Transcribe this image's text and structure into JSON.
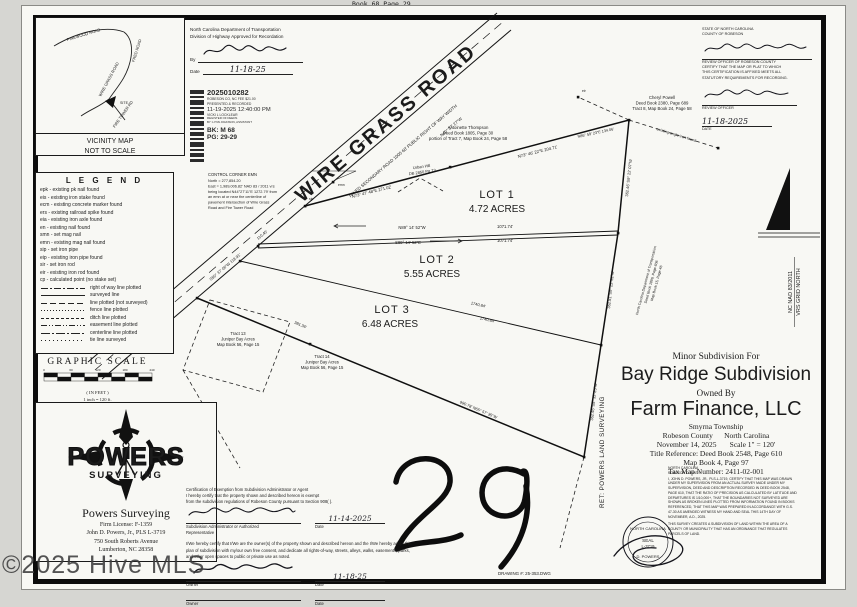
{
  "page": {
    "book_header": "Book 68 Page 29",
    "page_number": "29",
    "drawing_number": "DRAWING #: 25-353.DWG",
    "watermark": "©2025 Hive MLS",
    "ret_label": "RET: POWERS LAND SURVEYING"
  },
  "vicinity": {
    "roads": [
      "PINEWOOD ROAD",
      "FRED ROAD",
      "WIRE GRASS ROAD",
      "FIRE TOWER RD"
    ],
    "site_label": "SITE",
    "caption1": "VICINITY MAP",
    "caption2": "NOT TO SCALE"
  },
  "ncdot": {
    "line1": "North Carolina Department of Transportation",
    "line2": "Division of Highway Approved for Recordation",
    "by_label": "By",
    "date_label": "Date",
    "date_value": "11-18-25"
  },
  "stamp": {
    "number": "2025010282",
    "line1": "ROBESON CO, NC FEE $21.00",
    "line2": "PRESENTED & RECORDED",
    "datetime": "11-19-2025 12:40:00 PM",
    "registrar": "VICKI L LOCKLEAR",
    "registrar_title": "REGISTER OF DEEDS",
    "deputy": "BY: LYNN JOHNSON, ASSISTANT",
    "book": "BK: M 68",
    "page": "PG: 29-29"
  },
  "legend": {
    "title": "L E G E N D",
    "abbrevs": [
      "epk - existing pk nail found",
      "eis - existing iron stake found",
      "ecm - existing concrete marker found",
      "ers - existing railroad spike found",
      "eia - existing iron axle found",
      "en - existing nail found",
      "smn - set mag nail",
      "emn - existing mag nail found",
      "sip - set iron pipe",
      "eip - existing iron pipe found",
      "sir - set iron rod",
      "eir - existing iron rod found",
      "cp - calculated point (no stake set)"
    ],
    "lines": [
      {
        "label": "right of way line plotted",
        "dash": "7 2 2 2"
      },
      {
        "label": "surveyed line",
        "dash": ""
      },
      {
        "label": "line plotted (not surveyed)",
        "dash": "6 3"
      },
      {
        "label": "fence line plotted",
        "dash": "1 2"
      },
      {
        "label": "ditch line plotted",
        "dash": "3 2"
      },
      {
        "label": "easement line plotted",
        "dash": "6 2 1 2 1 2"
      },
      {
        "label": "centerline line plotted",
        "dash": "9 2 2 2"
      },
      {
        "label": "tie line surveyed",
        "dash": "1 3"
      }
    ]
  },
  "scale_bar": {
    "title": "GRAPHIC SCALE",
    "ticks": [
      "0",
      "60",
      "120",
      "180",
      "240"
    ],
    "units": "( IN FEET )",
    "note": "1 inch = 120 ft."
  },
  "powers": {
    "brand_top": "POWERS",
    "brand_bottom": "SURVEYING",
    "firm": "Powers Surveying",
    "license": "Firm License:  F-1359",
    "surveyor": "John D. Powers, Jr., PLS L-3719",
    "address1": "750 South Roberts Avenue",
    "address2": "Lumberton, NC 28358"
  },
  "review": {
    "state": "STATE OF NORTH CAROLINA",
    "county": "COUNTY OF ROBESON",
    "body1": "REVIEW OFFICER OF ROBESON COUNTY",
    "body2": "CERTIFY THAT THE MAP OR PLAT TO WHICH",
    "body3": "THIS CERTIFICATION IS AFFIXED MEETS ALL",
    "body4": "STATUTORY REQUIREMENTS FOR RECORDING.",
    "officer_label": "REVIEW OFFICER",
    "date_value": "11-18-2025",
    "date_label": "DATE"
  },
  "title_block": {
    "sub": "Minor Subdivision For",
    "name": "Bay Ridge Subdivision",
    "owned": "Owned By",
    "owner": "Farm Finance, LLC",
    "township": "Smyrna Township",
    "county": "Robeson County      North Carolina",
    "date_scale": "November 14, 2025       Scale 1\" = 120'",
    "ref1": "Title Reference:  Deed Book 2548, Page 610",
    "ref2": "Map Book 4, Page 97",
    "ref3": "Tax Map Number: 2411-02-001"
  },
  "surveyor_cert": {
    "state": "NORTH CAROLINA",
    "county": "ROBESON COUNTY",
    "body": "I, JOHN D. POWERS, JR., PLS-L-3719, CERTIFY THAT THIS MAP WAS DRAWN UNDER MY SUPERVISION FROM AN ACTUAL SURVEY MADE UNDER MY SUPERVISION, DEED AND DESCRIPTION RECORDED IN DEED BOOK 2548, PAGE 610, THAT THE RATIO OF PRECISION AS CALCULATED BY LATITUDE AND DEPARTURES IS 1/10,000+, THAT THE BOUNDARIES NOT SURVEYED ARE SHOWN AS BROKEN LINES PLOTTED FROM INFORMATION FOUND IN BOOKS REFERENCED, THAT THIS MAP WAS PREPARED IN ACCORDANCE WITH G.S. 47-30 AS AMENDED WITNESS MY HAND AND SEAL THIS 14TH DAY OF NOVEMBER, A.D., 2025.",
    "body2": "THIS SURVEY CREATES A SUBDIVISION OF LAND WITHIN THE AREA OF A COUNTY OR MUNICIPALITY THAT HAS AN ORDINANCE THAT REGULATES PARCELS OF LAND."
  },
  "seal": {
    "top": "NORTH CAROLINA",
    "mid1": "SEAL",
    "mid2": "L-3719",
    "bottom": "D. POWERS"
  },
  "exemption": {
    "title": "Certification of Exemption from Subdivision Administrator or Agent",
    "p1a": "I hereby certify that the property shown and described hereon is exempt",
    "p1b": "from the subdivision regulations of Robeson County pursuant to Section 908( ).",
    "admin_label1": "Subdivision Administrator or Authorized",
    "admin_label2": "Representative",
    "admin_date": "11-14-2025",
    "date_label": "Date",
    "p2": "I/We hereby certify that I/We are the owner(s) of the property shown and described hereon and the I/We hereby adopt this plan of subdivision with my/our own free consent, and dedicate all rights-of-way, streets, alleys, walks, easements, parks, and other open spaces to public or private use as noted.",
    "owner_label": "Owner",
    "owner_date": "11-18-25"
  },
  "north": {
    "line1": "NC NAD 83/2011",
    "line2": "VRS GRID NORTH"
  },
  "map": {
    "road_name": "WIRE GRASS ROAD",
    "road_sub": "PAVED SECONDARY ROAD 1005      60' PUBLIC RIGHT OF WAY WIDTH",
    "road_bearing": "N40° 27' 27\"W",
    "course1": "S50° 37' 06\"W  118.91'",
    "course2": "110.40'",
    "lots": [
      {
        "name": "LOT 1",
        "area": "4.72 ACRES"
      },
      {
        "name": "LOT 2",
        "area": "5.55 ACRES"
      },
      {
        "name": "LOT 3",
        "area": "6.48 ACRES"
      }
    ],
    "div1_above": "N89° 14' 52\"W",
    "div1_dist": "1071.74'",
    "div1_below": "S89° 14' 52\"E",
    "div1_dist2": "1071.74'",
    "div2_dist_a": "1740.84'",
    "div2_dist_b": "1740.84'",
    "east1": "362.46'   S9° 22' 07\"W",
    "east2": "362.81'   S9° 22' 52\"W",
    "east3": "362.46'   S8° 32' 23\"W",
    "south1": "381.36'",
    "south2": "990.78'    N65° 57' 35\"W",
    "north1": "N73° 47' 48\"E   271.02'",
    "north2": "N73° 46' 22\"E   204.71'",
    "tie1": "N86° 59' 23\"E  134.06'",
    "angle_iron": "existing angle iron found",
    "pt_eir": "eir",
    "pt_sip": "sip",
    "pt_emn": "emn",
    "antoinette": [
      "Antoinette Thompson",
      "Deed Book 1805, Page 30",
      "portion of Tract 7, Map Book 24, Page 58"
    ],
    "cheryl": [
      "Cheryl Powell",
      "Deed Book 2380, Page 689",
      "Tract 8, Map Book 24, Page 58"
    ],
    "urban": [
      "Urban Hill",
      "DB 2850 Pg 73"
    ],
    "tract13": [
      "Tract 13",
      "Juniper Bay Acres",
      "Map Book 56, Page 15"
    ],
    "tract14": [
      "Tract 14",
      "Juniper Bay Acres",
      "Map Book 56, Page 15"
    ],
    "ncdot_e": [
      "North Carolina Department of Transportation",
      "Deed Book 1896, Page 606",
      "Map Book 15, Page 46"
    ],
    "control": [
      "CONTROL CORNER EMN",
      "North = 277,854.20",
      "East = 1,989,006.82' NAD 83 / 2011 vrs",
      "being located N44°27'11\"E  1272.79' from",
      "an emn at or near the centerline of",
      "pavement intersection of Wire Grass",
      "Road and Fire Tower Road"
    ]
  }
}
